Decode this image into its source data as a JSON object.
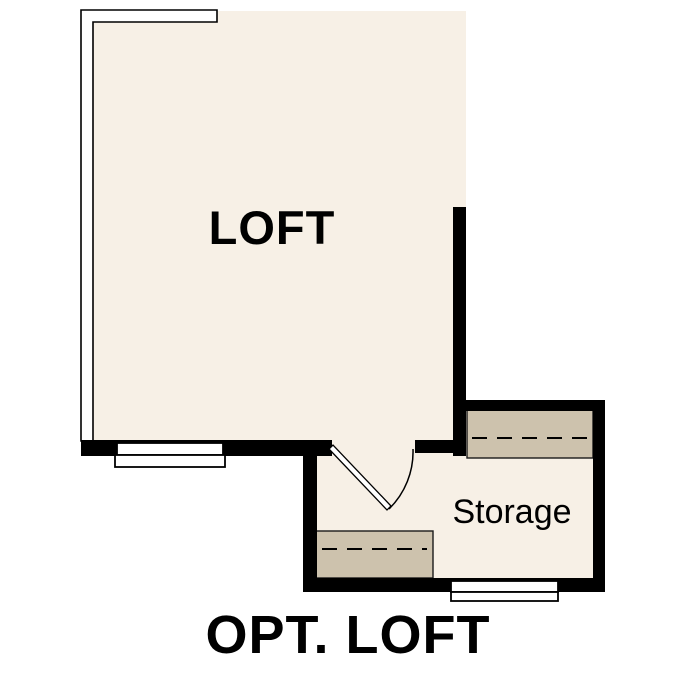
{
  "floorplan": {
    "caption": "OPT. LOFT",
    "rooms": [
      {
        "label": "LOFT"
      },
      {
        "label": "Storage"
      }
    ]
  },
  "colors": {
    "background": "#ffffff",
    "floor": "#f7f0e6",
    "shelf": "#cdc2ad",
    "wall": "#000000",
    "window": "#ffffff",
    "label_text": "#000000"
  }
}
